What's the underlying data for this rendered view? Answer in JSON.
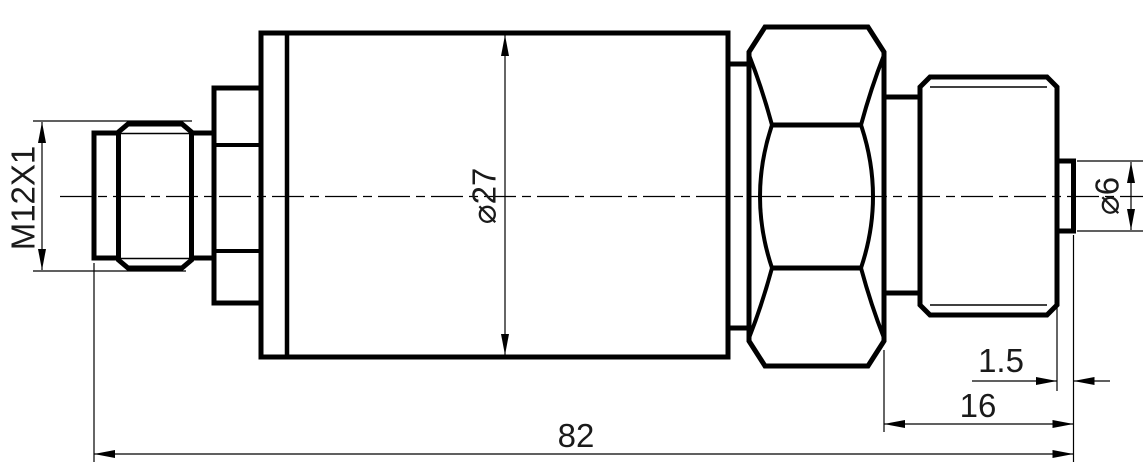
{
  "drawing": {
    "kind": "engineering-drawing",
    "view": "pressure-transmitter-side-view",
    "background_color": "#ffffff",
    "line_color": "#000000",
    "dimension_labels": {
      "thread_spec": "M12X1",
      "body_diameter": "⌀27",
      "tip_diameter": "⌀6",
      "tip_length": "1.5",
      "port_length": "16",
      "overall_length": "82"
    }
  }
}
